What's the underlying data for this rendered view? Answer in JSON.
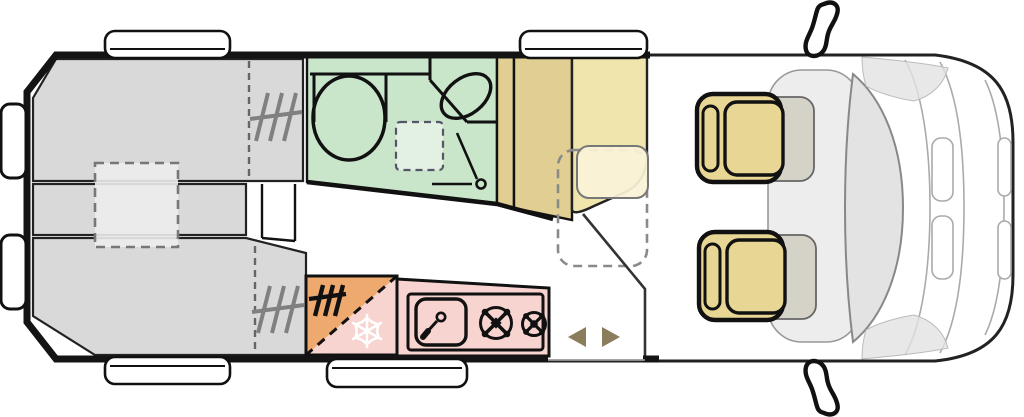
{
  "title": "Campervan floor plan (top view)",
  "palette": {
    "wall": "#141414",
    "outline": "#222222",
    "bed": "#d9d9d9",
    "bed_infill": "#ececec",
    "bathroom": "#c9e5ca",
    "shower": "#e2f1e2",
    "wardrobe": "#e0ce92",
    "bench": "#f0e5ad",
    "table": "#faf3d8",
    "seat": "#e8d794",
    "seat_ghost": "rgba(150,140,105,0.28)",
    "fridge_orange": "#eeaa6e",
    "kitchen_pink": "#f8d4d1",
    "door_marker": "#8b7d5b",
    "vent_gray": "#808080",
    "cab_gray": "#ededed",
    "windshield": "#e3e3e3",
    "detail_gray": "#aaaaaa",
    "snowflake": "#ffffff",
    "glass_white": "#ffffff"
  },
  "areas": [
    {
      "name": "rear-single-bed-top",
      "color_key": "bed"
    },
    {
      "name": "rear-single-bed-bottom",
      "color_key": "bed"
    },
    {
      "name": "bed-infill-cushion",
      "color_key": "bed_infill"
    },
    {
      "name": "washroom",
      "color_key": "bathroom"
    },
    {
      "name": "shower-tray",
      "color_key": "shower"
    },
    {
      "name": "wardrobe",
      "color_key": "wardrobe"
    },
    {
      "name": "dinette-bench",
      "color_key": "bench"
    },
    {
      "name": "dinette-table",
      "color_key": "table"
    },
    {
      "name": "fridge-freezer",
      "color_key": "fridge_orange"
    },
    {
      "name": "kitchen-unit",
      "color_key": "kitchen_pink"
    },
    {
      "name": "driver-seat-swivelled",
      "color_key": "seat"
    },
    {
      "name": "passenger-seat-swivelled",
      "color_key": "seat"
    },
    {
      "name": "cab",
      "color_key": "cab_gray"
    }
  ],
  "fixtures": [
    "toilet",
    "washbasin",
    "shower-door",
    "kitchen-sink",
    "hob-burner-large",
    "hob-burner-small",
    "heater-vent-top-bed",
    "heater-vent-bottom-bed",
    "heater-vent-fridge",
    "sliding-door-markers",
    "window-top-rear",
    "window-top-front",
    "window-bottom-rear",
    "window-kitchen",
    "rear-door-handle-top",
    "rear-door-handle-bottom",
    "side-mirror-top",
    "side-mirror-bottom",
    "windshield"
  ]
}
